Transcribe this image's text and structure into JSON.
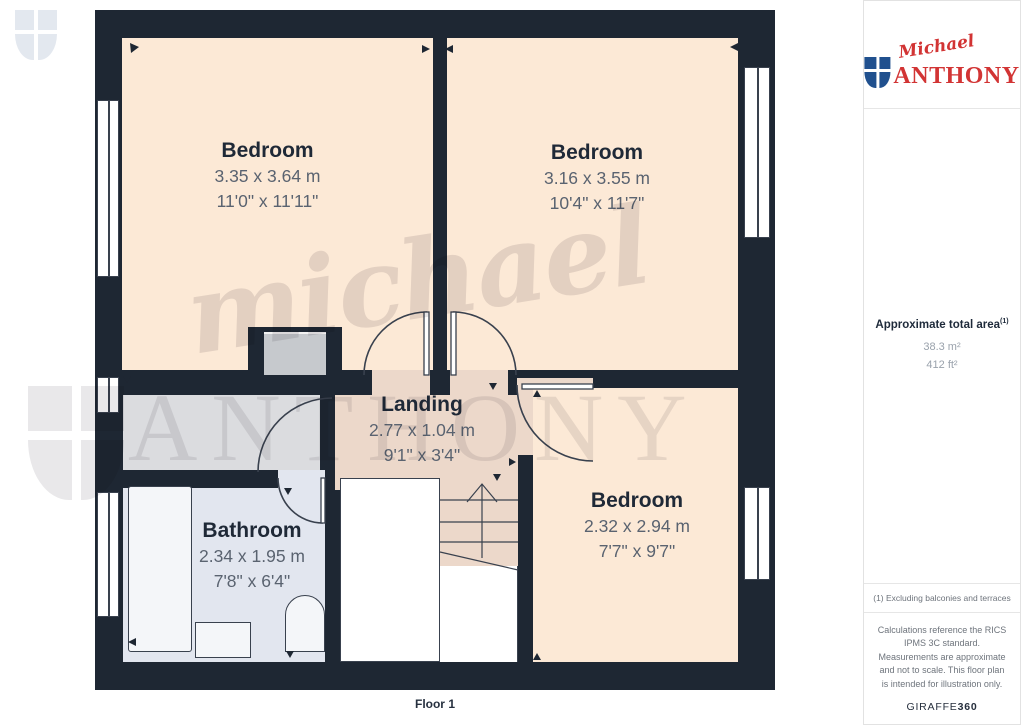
{
  "plan": {
    "rooms": [
      {
        "name": "Bedroom",
        "metric": "3.35 x 3.64 m",
        "imperial": "11'0\" x 11'11\""
      },
      {
        "name": "Bedroom",
        "metric": "3.16 x 3.55 m",
        "imperial": "10'4\" x 11'7\""
      },
      {
        "name": "Landing",
        "metric": "2.77 x 1.04 m",
        "imperial": "9'1\" x 3'4\""
      },
      {
        "name": "Bathroom",
        "metric": "2.34 x 1.95 m",
        "imperial": "7'8\" x 6'4\""
      },
      {
        "name": "Bedroom",
        "metric": "2.32 x 2.94 m",
        "imperial": "7'7\" x 9'7\""
      }
    ],
    "floor_label": "Floor 1"
  },
  "watermark": {
    "script": "michael",
    "caps": "ANTHONY"
  },
  "sidebar": {
    "logo": {
      "script": "Michael",
      "caps": "ANTHONY"
    },
    "area": {
      "title": "Approximate total area",
      "footnote_ref": "(1)",
      "metric": "38.3 m²",
      "imperial": "412 ft²"
    },
    "footnote": "(1) Excluding balconies and terraces",
    "disclaimer": "Calculations reference the RICS IPMS 3C standard. Measurements are approximate and not to scale. This floor plan is intended for illustration only.",
    "brand": {
      "name": "GIRAFFE",
      "suffix": "360"
    }
  },
  "colors": {
    "wall": "#1e2733",
    "bedroom_floor": "#fce9d6",
    "landing_floor": "#ecd8ca",
    "bathroom_floor": "#e2e6ef",
    "logo_red": "#d23434",
    "shield_blue": "#20508e"
  }
}
